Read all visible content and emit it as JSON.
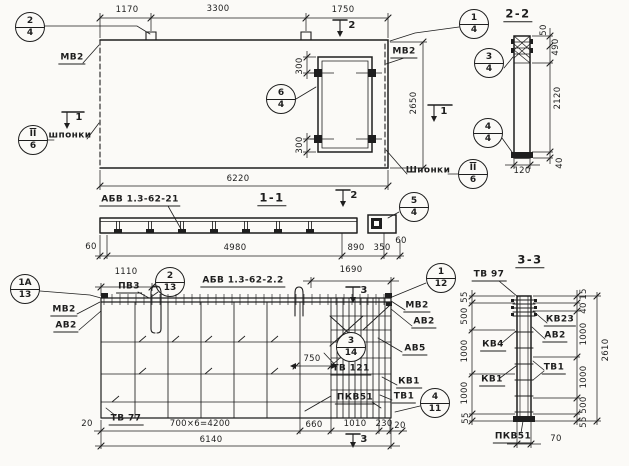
{
  "sections": {
    "s11": "1-1",
    "s22": "2-2",
    "s33": "3-3"
  },
  "cuts": {
    "c1": "1",
    "c2": "2",
    "c3": "3"
  },
  "marks": {
    "mv2": "МВ2",
    "av2": "АВ2",
    "av5": "АВ5",
    "kv1": "КВ1",
    "kv4": "КВ4",
    "kv23": "КВ23",
    "tv1": "ТВ1",
    "tv77": "ТВ 77",
    "tv97": "ТВ 97",
    "tv121": "ТВ 121",
    "pkv51": "ПКВ51",
    "pv3": "ПВ3",
    "keys_lower": "шпонки",
    "keys_upper": "Шпонки",
    "series_21": "АБВ 1.3-62-21",
    "series_22": "АБВ 1.3-62-2.2"
  },
  "dims": {
    "d15": "15",
    "d20": "20",
    "d40": "40",
    "d50": "50",
    "d55": "55",
    "d60": "60",
    "d70": "70",
    "d120": "120",
    "d230": "230",
    "d300": "300",
    "d350": "350",
    "d490": "490",
    "d500": "500",
    "d660": "660",
    "d750": "750",
    "d890": "890",
    "d1000": "1000",
    "d1010": "1010",
    "d1110": "1110",
    "d1170": "1170",
    "d1690": "1690",
    "d1750": "1750",
    "d2120": "2120",
    "d2610": "2610",
    "d2650": "2650",
    "d3300": "3300",
    "d4200": "700×6=4200",
    "d4980": "4980",
    "d6140": "6140",
    "d6220": "6220"
  },
  "callouts": {
    "c2_4": {
      "top": "2",
      "bottom": "4"
    },
    "c1_4": {
      "top": "1",
      "bottom": "4"
    },
    "c6_4": {
      "top": "6",
      "bottom": "4"
    },
    "c3_4": {
      "top": "3",
      "bottom": "4"
    },
    "c4_4": {
      "top": "4",
      "bottom": "4"
    },
    "c5_4": {
      "top": "5",
      "bottom": "4"
    },
    "cII_6": {
      "top": "II",
      "bottom": "6"
    },
    "c1a_13": {
      "top": "1А",
      "bottom": "13"
    },
    "c2_13": {
      "top": "2",
      "bottom": "13"
    },
    "c1_12": {
      "top": "1",
      "bottom": "12"
    },
    "c3_14": {
      "top": "3",
      "bottom": "14"
    },
    "c4_11": {
      "top": "4",
      "bottom": "11"
    }
  }
}
